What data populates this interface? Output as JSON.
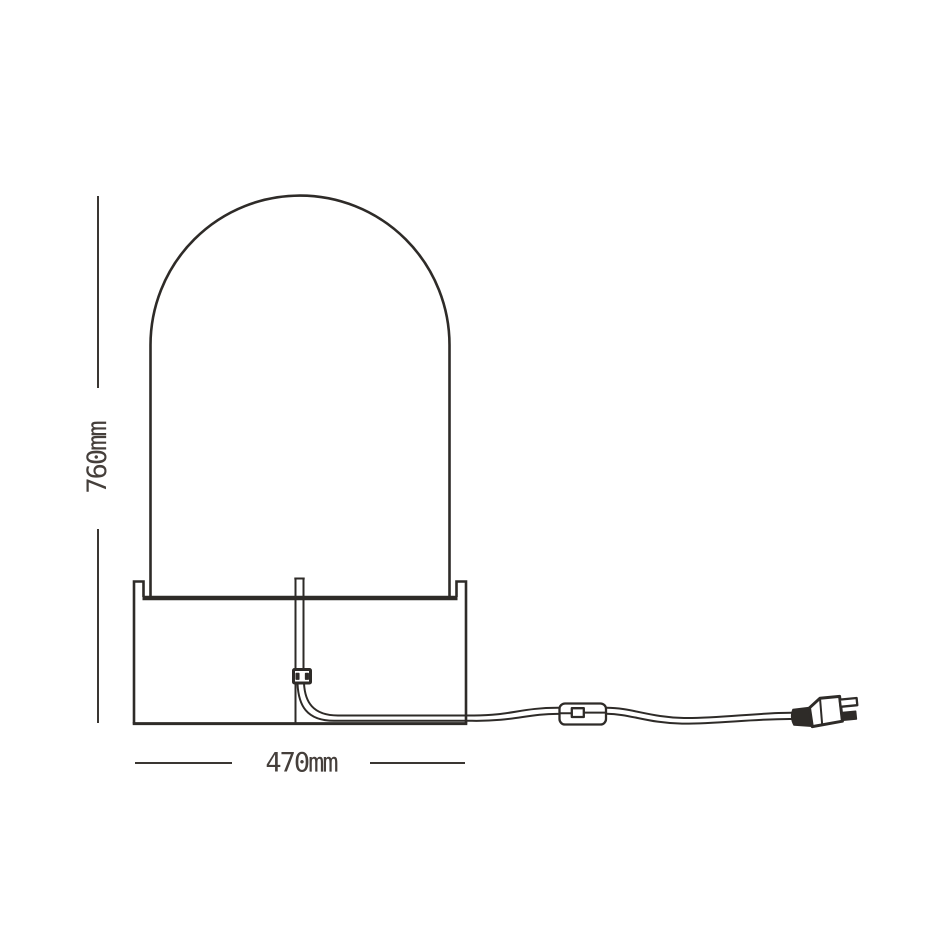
{
  "figure": {
    "title": "Arched table lamp - dimensional line drawing",
    "parts": [
      "lamp-shade-arch",
      "lamp-base",
      "center-stem",
      "socket-block",
      "power-cord",
      "inline-switch",
      "power-plug"
    ]
  },
  "dimensions": {
    "height": {
      "label": "760mm",
      "value": 760,
      "unit": "mm"
    },
    "width": {
      "label": "470mm",
      "value": 470,
      "unit": "mm"
    }
  },
  "colors": {
    "background": "#ffffff",
    "line": "#2e2b28",
    "dim-line": "#3a3632",
    "text": "#453f3b"
  }
}
